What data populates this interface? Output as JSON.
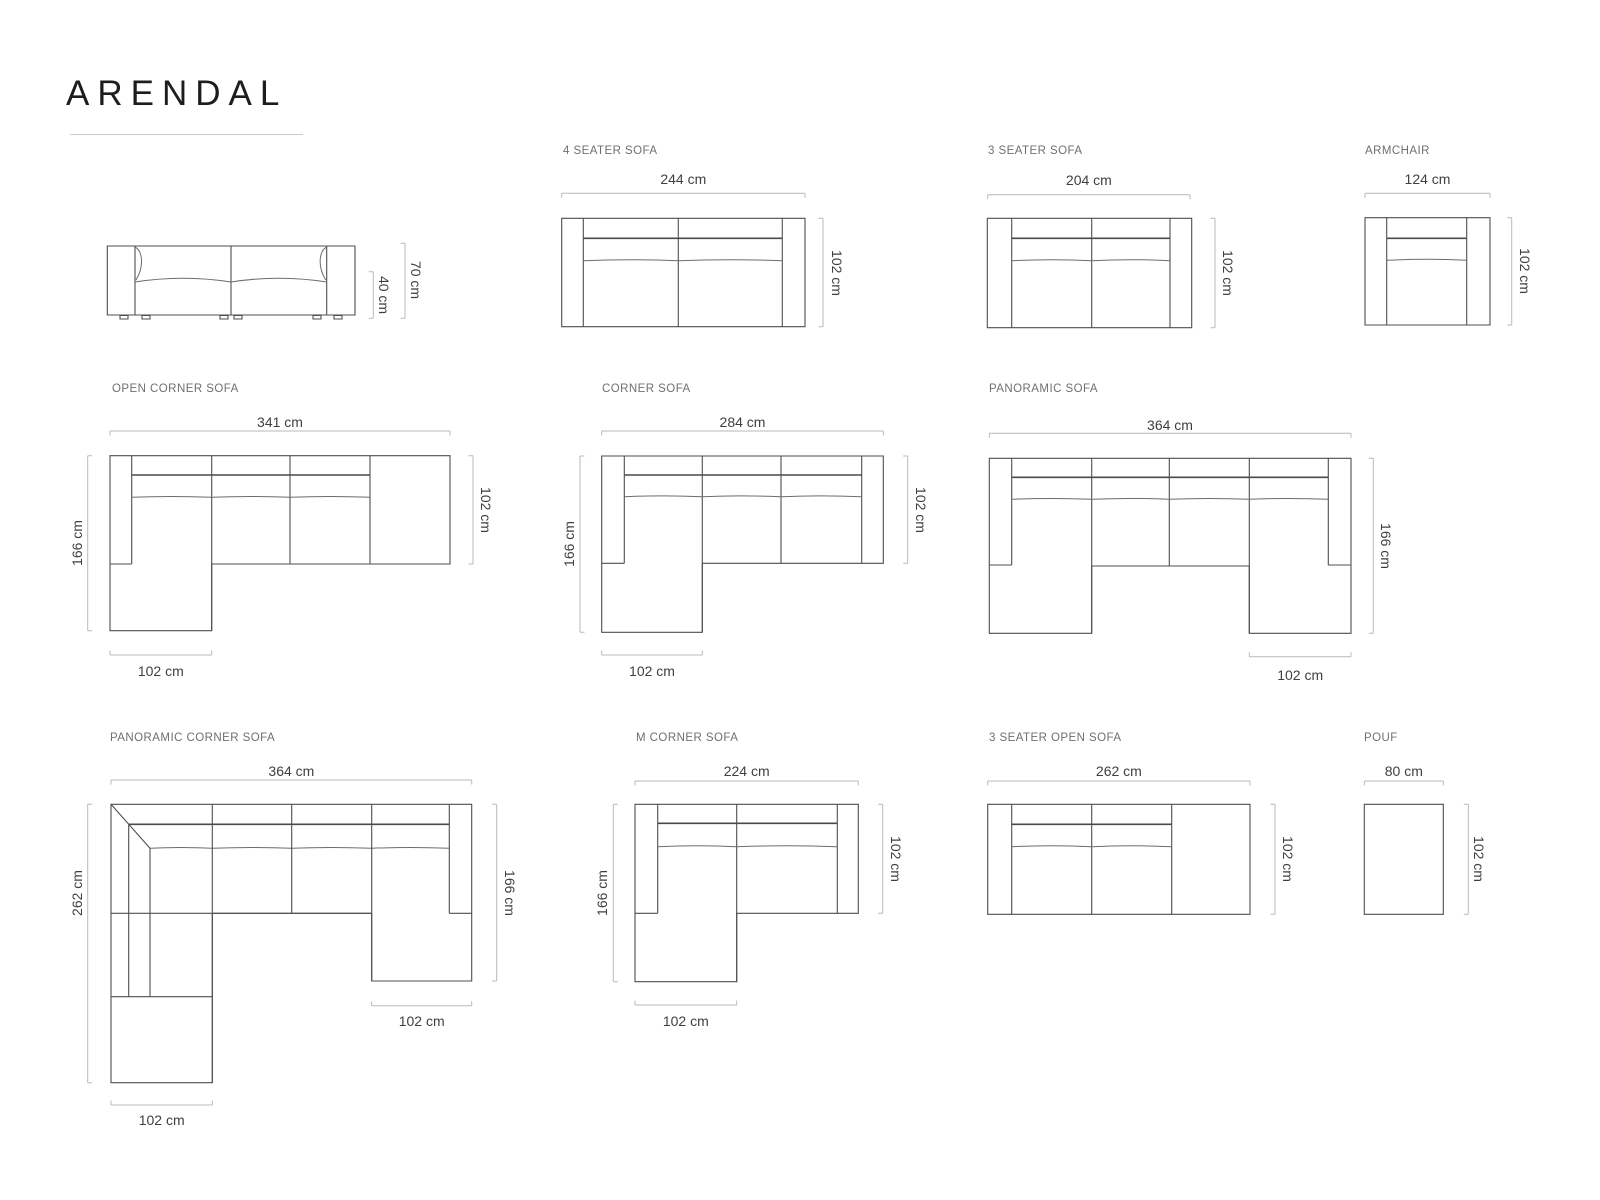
{
  "title": "ARENDAL",
  "colors": {
    "line": "#4f4f4f",
    "dim_line": "#b9b9b9",
    "label_text": "#6f6f6f",
    "dim_text": "#3f3f3f",
    "title_text": "#1d1d1d"
  },
  "products": [
    {
      "id": "side-view-sofa",
      "label": "",
      "dims": {
        "height_total": "70 cm",
        "height_seat": "40 cm"
      }
    },
    {
      "id": "4-seater-sofa",
      "label": "4 SEATER SOFA",
      "dims": {
        "width": "244 cm",
        "depth": "102 cm"
      }
    },
    {
      "id": "3-seater-sofa",
      "label": "3 SEATER SOFA",
      "dims": {
        "width": "204 cm",
        "depth": "102 cm"
      }
    },
    {
      "id": "armchair",
      "label": "ARMCHAIR",
      "dims": {
        "width": "124 cm",
        "depth": "102 cm"
      }
    },
    {
      "id": "open-corner-sofa",
      "label": "OPEN CORNER SOFA",
      "dims": {
        "width": "341 cm",
        "depth_total": "166 cm",
        "depth": "102 cm",
        "chaise_width": "102 cm"
      }
    },
    {
      "id": "corner-sofa",
      "label": "CORNER SOFA",
      "dims": {
        "width": "284 cm",
        "depth_total": "166 cm",
        "depth": "102 cm",
        "chaise_width": "102 cm"
      }
    },
    {
      "id": "panoramic-sofa",
      "label": "PANORAMIC SOFA",
      "dims": {
        "width": "364 cm",
        "depth_total": "166 cm",
        "chaise_width": "102 cm"
      }
    },
    {
      "id": "panoramic-corner-sofa",
      "label": "PANORAMIC CORNER SOFA",
      "dims": {
        "width": "364 cm",
        "depth_left": "262 cm",
        "depth_right": "166 cm",
        "chaise_width_right": "102 cm",
        "chaise_width_left": "102 cm"
      }
    },
    {
      "id": "m-corner-sofa",
      "label": "M CORNER SOFA",
      "dims": {
        "width": "224 cm",
        "depth_total": "166 cm",
        "depth": "102 cm",
        "chaise_width": "102 cm"
      }
    },
    {
      "id": "3-seater-open-sofa",
      "label": "3 SEATER OPEN SOFA",
      "dims": {
        "width": "262 cm",
        "depth": "102 cm"
      }
    },
    {
      "id": "pouf",
      "label": "POUF",
      "dims": {
        "width": "80 cm",
        "depth": "102 cm"
      }
    }
  ]
}
